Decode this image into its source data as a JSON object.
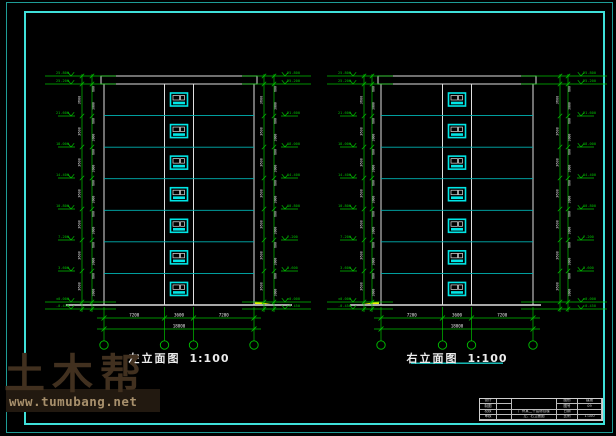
{
  "watermark": {
    "brand": "土木帮",
    "url": "www.tumubang.net"
  },
  "drawings": [
    {
      "title": "左立面图",
      "scale": "1:100"
    },
    {
      "title": "右立面图",
      "scale": "1:100"
    }
  ],
  "title_block": {
    "left_rows": [
      "设计",
      "制图",
      "校核",
      "审核"
    ],
    "project_name": "广州某二十层综合楼",
    "drawing_name": "左、右立面图",
    "right_rows": [
      [
        "图别",
        "建施"
      ],
      [
        "图号",
        "09"
      ],
      [
        "日期",
        ""
      ],
      [
        "比例",
        "1:100"
      ]
    ]
  },
  "cad": {
    "colors": {
      "green": "#00c000",
      "white": "#e0e0e0",
      "cyan": "#00b4b4",
      "window": "#00e6e6",
      "yellow": "#f0f000",
      "dim_text": "#e8e8e8",
      "underline": "#19c8c4"
    },
    "levels": [
      "25.800",
      "25.200",
      "21.600",
      "18.000",
      "14.400",
      "10.800",
      "7.200",
      "3.600",
      "±0.000",
      "-0.450"
    ],
    "level_y": [
      76,
      84,
      116,
      147,
      178,
      209,
      240,
      271,
      302,
      309
    ],
    "floor_dim": "3600",
    "sub_dims": [
      "600",
      "3000"
    ],
    "bottom_dims": [
      "7200",
      "3600",
      "7200"
    ],
    "total_dim": "18000",
    "geometry": {
      "parapet_top": 76,
      "body_top": 84,
      "ground": 305,
      "floors": 7,
      "window": {
        "w": 17,
        "h": 13,
        "col_half": 14.5
      }
    },
    "views": [
      {
        "bx": 104,
        "bw": 150,
        "ground_x": [
          66,
          292
        ],
        "arrow_x": 263,
        "arrow_dir": 1,
        "underline": false,
        "sides": [
          {
            "chain": [
              82,
              92
            ],
            "marker_x": 71,
            "dir": -1
          },
          {
            "chain": [
              264,
              274
            ],
            "marker_x": 285,
            "dir": 1
          }
        ]
      },
      {
        "bx": 381,
        "bw": 152,
        "ground_x": [
          350,
          541
        ],
        "arrow_x": 371,
        "arrow_dir": -1,
        "underline": true,
        "sides": [
          {
            "chain": [
              364,
              372
            ],
            "marker_x": 353,
            "dir": -1
          },
          {
            "chain": [
              560,
              568
            ],
            "marker_x": 581,
            "dir": 1
          }
        ]
      }
    ]
  }
}
